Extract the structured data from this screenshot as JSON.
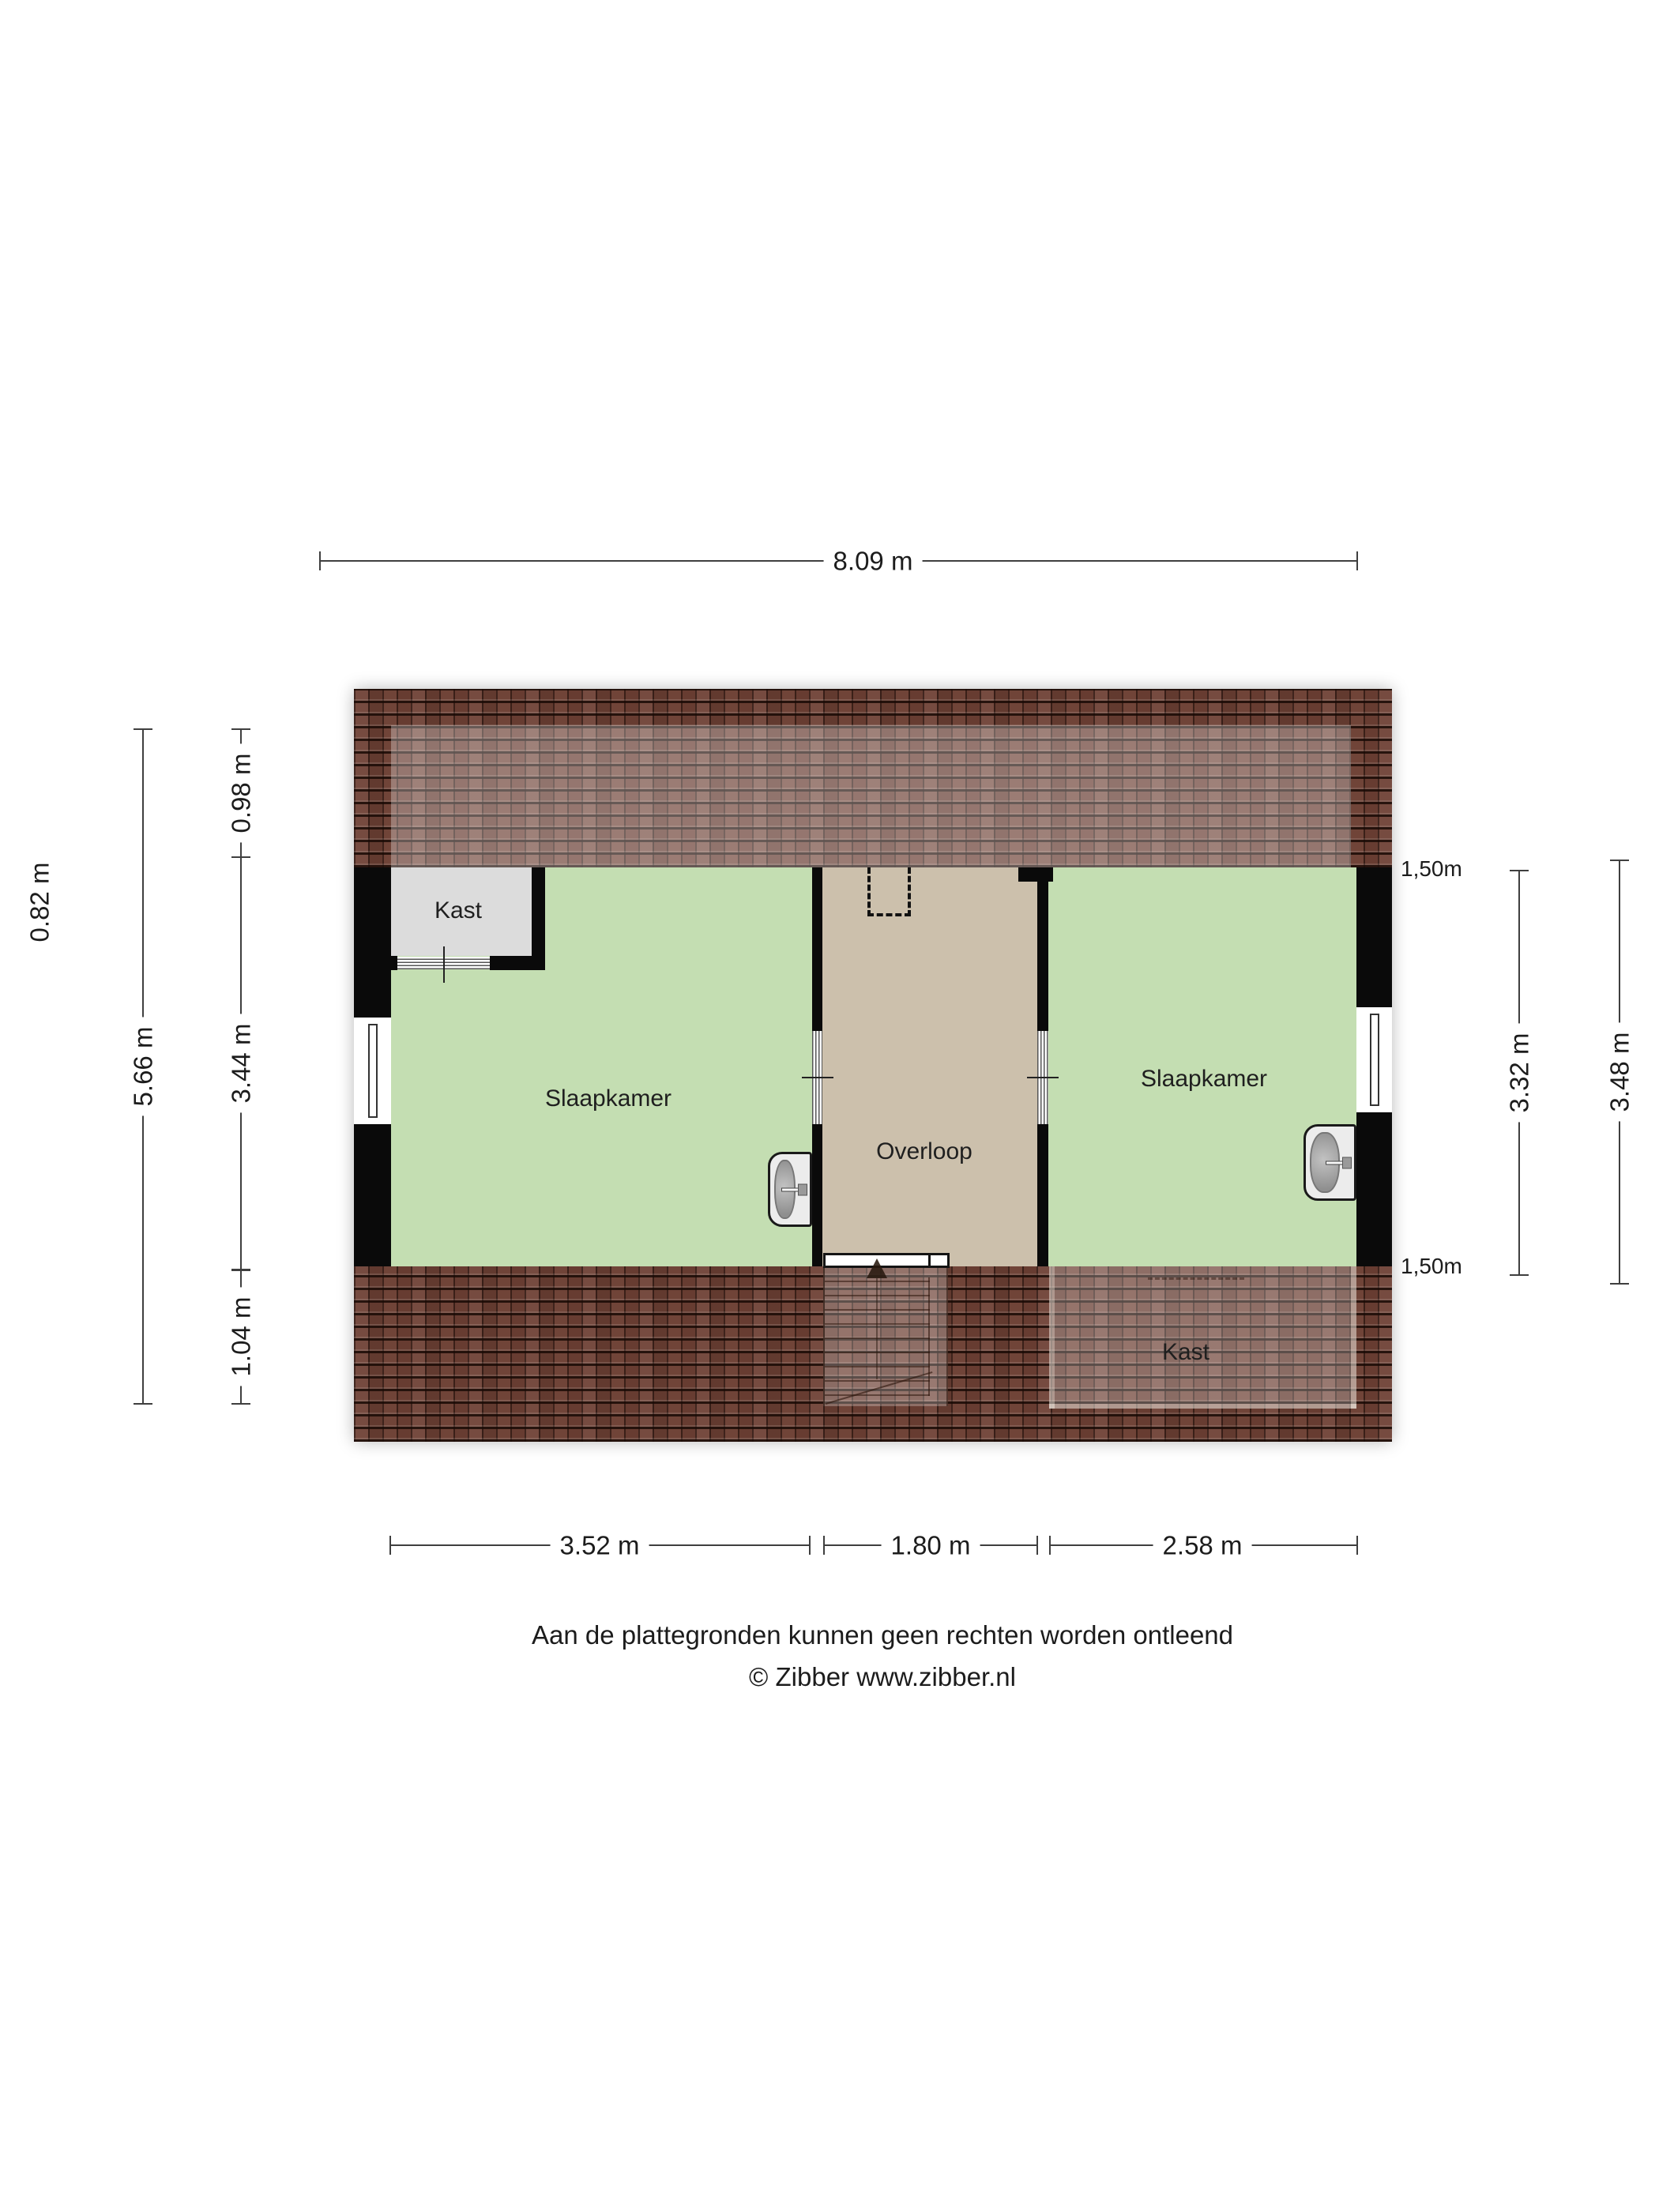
{
  "rooms": {
    "kast_top": {
      "label": "Kast"
    },
    "slaapkamer_left": {
      "label": "Slaapkamer"
    },
    "overloop": {
      "label": "Overloop"
    },
    "slaapkamer_right": {
      "label": "Slaapkamer"
    },
    "kast_bottom": {
      "label": "Kast"
    }
  },
  "dimensions": {
    "top": {
      "label": "8.09 m"
    },
    "left_outer_text": {
      "label": "0.82 m"
    },
    "left_total": {
      "label": "5.66 m"
    },
    "left_inner": [
      {
        "label": "0.98 m"
      },
      {
        "label": "3.44 m"
      },
      {
        "label": "1.04 m"
      }
    ],
    "right_headroom_top": {
      "label": "1,50m"
    },
    "right_inner": {
      "label": "3.32 m"
    },
    "right_outer": {
      "label": "3.48 m"
    },
    "right_headroom_bottom": {
      "label": "1,50m"
    },
    "bottom": [
      {
        "label": "3.52 m"
      },
      {
        "label": "1.80 m"
      },
      {
        "label": "2.58 m"
      }
    ]
  },
  "footer": {
    "disclaimer": "Aan de plattegronden kunnen geen rechten worden ontleend",
    "credit": "© Zibber www.zibber.nl"
  },
  "colors": {
    "bedroom_floor": "#c4deb2",
    "hall_floor": "#ccc0ac",
    "closet_floor": "#dcdcdc",
    "roof_tiles": "#6d4034",
    "walls": "#0a0a0a"
  }
}
